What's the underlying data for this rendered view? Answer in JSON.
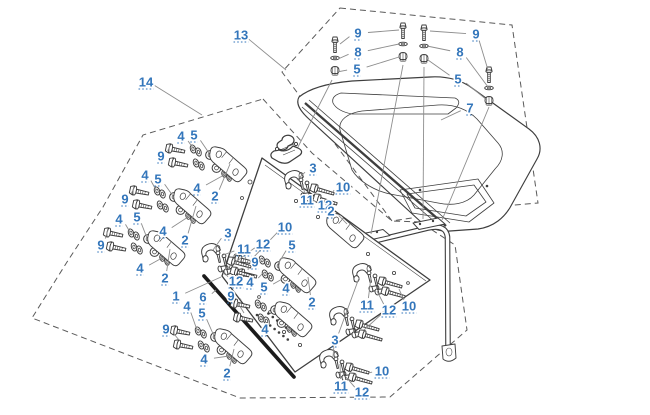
{
  "diagram": {
    "width": 650,
    "height": 415
  },
  "colors": {
    "label_blue": "#3376BB",
    "part_line": "#3E3E3E",
    "leader_gray": "#8D8D8D",
    "boundary_gray": "#5A5A5A",
    "seal_black": "#1B1B1B",
    "background": "#FFFFFF"
  },
  "callouts": [
    {
      "text": "13",
      "x": 241,
      "y": 35,
      "targets": [
        [
          286,
          70
        ]
      ]
    },
    {
      "text": "9",
      "x": 358,
      "y": 33,
      "targets": [
        [
          340,
          44
        ],
        [
          399,
          30
        ]
      ]
    },
    {
      "text": "8",
      "x": 358,
      "y": 52,
      "targets": [
        [
          338,
          59
        ],
        [
          399,
          44
        ]
      ]
    },
    {
      "text": "5",
      "x": 357,
      "y": 69,
      "targets": [
        [
          337,
          72
        ],
        [
          399,
          57
        ]
      ]
    },
    {
      "text": "9",
      "x": 476,
      "y": 34,
      "targets": [
        [
          430,
          31
        ],
        [
          488,
          70
        ]
      ]
    },
    {
      "text": "8",
      "x": 460,
      "y": 52,
      "targets": [
        [
          427,
          46
        ],
        [
          488,
          87
        ]
      ]
    },
    {
      "text": "5",
      "x": 458,
      "y": 79,
      "targets": [
        [
          428,
          60
        ],
        [
          487,
          100
        ]
      ]
    },
    {
      "text": "7",
      "x": 470,
      "y": 108,
      "targets": [
        [
          441,
          120
        ]
      ]
    },
    {
      "text": "14",
      "x": 146,
      "y": 82,
      "targets": [
        [
          202,
          115
        ]
      ]
    },
    {
      "text": "4",
      "x": 181,
      "y": 136,
      "targets": [
        [
          193,
          148
        ]
      ]
    },
    {
      "text": "5",
      "x": 194,
      "y": 135,
      "targets": [
        [
          209,
          153
        ]
      ]
    },
    {
      "text": "9",
      "x": 161,
      "y": 156,
      "targets": [
        [
          170,
          146
        ],
        [
          173,
          159
        ]
      ]
    },
    {
      "text": "4",
      "x": 197,
      "y": 188,
      "targets": [
        [
          224,
          175
        ]
      ]
    },
    {
      "text": "2",
      "x": 215,
      "y": 196,
      "targets": [
        [
          230,
          164
        ]
      ]
    },
    {
      "text": "4",
      "x": 145,
      "y": 175,
      "targets": [
        [
          156,
          190
        ]
      ]
    },
    {
      "text": "5",
      "x": 158,
      "y": 179,
      "targets": [
        [
          173,
          196
        ]
      ]
    },
    {
      "text": "9",
      "x": 125,
      "y": 199,
      "targets": [
        [
          134,
          188
        ],
        [
          137,
          201
        ]
      ]
    },
    {
      "text": "4",
      "x": 163,
      "y": 231,
      "targets": [
        [
          188,
          217
        ]
      ]
    },
    {
      "text": "2",
      "x": 185,
      "y": 240,
      "targets": [
        [
          196,
          206
        ]
      ]
    },
    {
      "text": "4",
      "x": 119,
      "y": 219,
      "targets": [
        [
          130,
          232
        ]
      ]
    },
    {
      "text": "5",
      "x": 137,
      "y": 217,
      "targets": [
        [
          147,
          238
        ]
      ]
    },
    {
      "text": "9",
      "x": 101,
      "y": 245,
      "targets": [
        [
          108,
          230
        ],
        [
          111,
          243
        ]
      ]
    },
    {
      "text": "4",
      "x": 140,
      "y": 268,
      "targets": [
        [
          162,
          258
        ]
      ]
    },
    {
      "text": "2",
      "x": 165,
      "y": 278,
      "targets": [
        [
          170,
          249
        ]
      ]
    },
    {
      "text": "4",
      "x": 187,
      "y": 306,
      "targets": [
        [
          197,
          330
        ]
      ]
    },
    {
      "text": "5",
      "x": 202,
      "y": 313,
      "targets": [
        [
          214,
          336
        ]
      ]
    },
    {
      "text": "9",
      "x": 166,
      "y": 329,
      "targets": [
        [
          176,
          327
        ],
        [
          179,
          340
        ]
      ]
    },
    {
      "text": "4",
      "x": 204,
      "y": 359,
      "targets": [
        [
          229,
          356
        ]
      ]
    },
    {
      "text": "2",
      "x": 227,
      "y": 373,
      "targets": [
        [
          234,
          349
        ]
      ]
    },
    {
      "text": "1",
      "x": 176,
      "y": 296,
      "targets": [
        [
          221,
          277
        ]
      ]
    },
    {
      "text": "6",
      "x": 203,
      "y": 297,
      "targets": [
        [
          216,
          290
        ]
      ]
    },
    {
      "text": "3",
      "x": 313,
      "y": 168,
      "targets": [
        [
          297,
          180
        ]
      ]
    },
    {
      "text": "11",
      "x": 307,
      "y": 200,
      "targets": [
        [
          303,
          184
        ]
      ]
    },
    {
      "text": "12",
      "x": 325,
      "y": 205,
      "targets": [
        [
          308,
          197
        ]
      ]
    },
    {
      "text": "10",
      "x": 343,
      "y": 187,
      "targets": [
        [
          333,
          192
        ]
      ]
    },
    {
      "text": "2",
      "x": 331,
      "y": 211,
      "targets": [
        [
          347,
          224
        ]
      ]
    },
    {
      "text": "3",
      "x": 228,
      "y": 233,
      "targets": [
        [
          213,
          250
        ]
      ]
    },
    {
      "text": "11",
      "x": 244,
      "y": 249,
      "targets": [
        [
          223,
          255
        ]
      ]
    },
    {
      "text": "12",
      "x": 263,
      "y": 244,
      "targets": [
        [
          226,
          269
        ]
      ]
    },
    {
      "text": "10",
      "x": 285,
      "y": 227,
      "targets": [
        [
          250,
          261
        ]
      ]
    },
    {
      "text": "5",
      "x": 292,
      "y": 245,
      "targets": [
        [
          278,
          264
        ]
      ]
    },
    {
      "text": "9",
      "x": 255,
      "y": 262,
      "targets": [
        [
          245,
          257
        ],
        [
          248,
          270
        ]
      ]
    },
    {
      "text": "12",
      "x": 236,
      "y": 281,
      "targets": [
        [
          224,
          272
        ]
      ]
    },
    {
      "text": "4",
      "x": 250,
      "y": 282,
      "targets": [
        [
          263,
          273
        ]
      ]
    },
    {
      "text": "5",
      "x": 264,
      "y": 287,
      "targets": [
        [
          284,
          278
        ]
      ]
    },
    {
      "text": "4",
      "x": 286,
      "y": 288,
      "targets": [
        [
          293,
          285
        ]
      ]
    },
    {
      "text": "2",
      "x": 312,
      "y": 302,
      "targets": [
        [
          308,
          277
        ]
      ]
    },
    {
      "text": "9",
      "x": 231,
      "y": 296,
      "targets": [
        [
          241,
          300
        ],
        [
          244,
          313
        ]
      ]
    },
    {
      "text": "4",
      "x": 265,
      "y": 329,
      "targets": [
        [
          263,
          317
        ]
      ]
    },
    {
      "text": "11",
      "x": 367,
      "y": 305,
      "targets": [
        [
          371,
          277
        ]
      ]
    },
    {
      "text": "12",
      "x": 389,
      "y": 310,
      "targets": [
        [
          377,
          291
        ],
        [
          364,
          330
        ]
      ]
    },
    {
      "text": "10",
      "x": 409,
      "y": 306,
      "targets": [
        [
          399,
          289
        ]
      ]
    },
    {
      "text": "3",
      "x": 335,
      "y": 340,
      "targets": [
        [
          359,
          278
        ],
        [
          333,
          357
        ]
      ]
    },
    {
      "text": "11",
      "x": 341,
      "y": 386,
      "targets": [
        [
          340,
          364
        ]
      ]
    },
    {
      "text": "12",
      "x": 362,
      "y": 392,
      "targets": [
        [
          346,
          377
        ]
      ]
    },
    {
      "text": "10",
      "x": 382,
      "y": 371,
      "targets": [
        [
          369,
          373
        ]
      ]
    }
  ]
}
